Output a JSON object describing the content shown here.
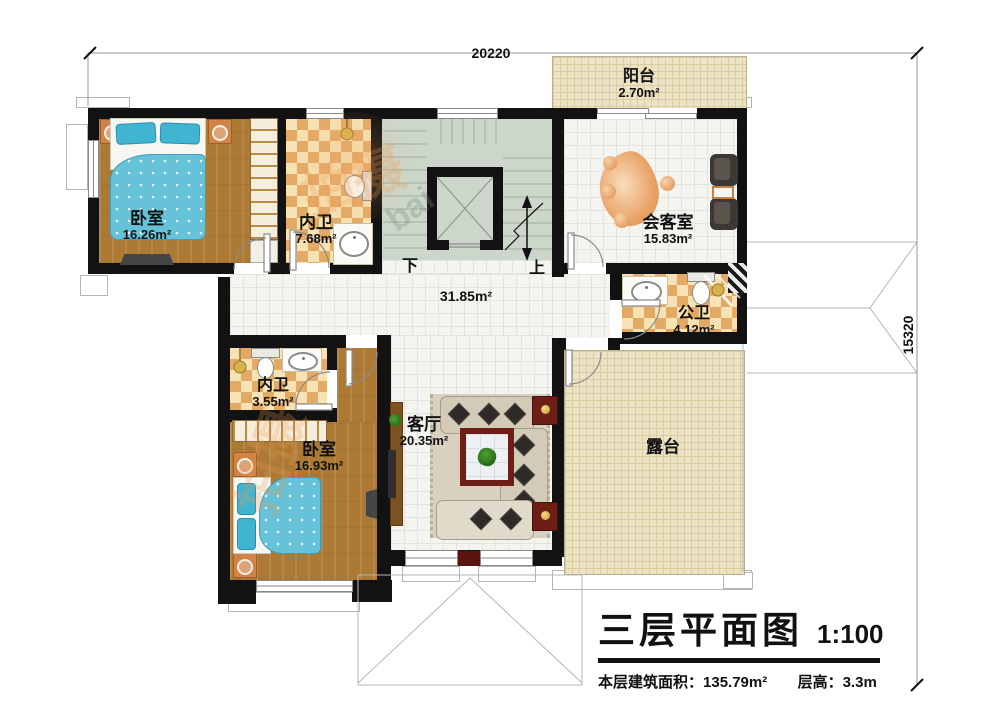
{
  "dimensions": {
    "top": "20220",
    "right": "15320"
  },
  "rooms": {
    "bedroom1": {
      "name": "卧室",
      "area": "16.26m²"
    },
    "bath1": {
      "name": "内卫",
      "area": "7.68m²"
    },
    "reception": {
      "name": "会客室",
      "area": "15.83m²"
    },
    "balcony": {
      "name": "阳台",
      "area": "2.70m²"
    },
    "public_bath": {
      "name": "公卫",
      "area": "4.12m²"
    },
    "bath2": {
      "name": "内卫",
      "area": "3.55m²"
    },
    "bedroom2": {
      "name": "卧室",
      "area": "16.93m²"
    },
    "living": {
      "name": "客厅",
      "area": "20.35m²"
    },
    "terrace": {
      "name": "露台"
    },
    "hall": {
      "area": "31.85m²"
    }
  },
  "stairs": {
    "down": "下",
    "up": "上"
  },
  "title": {
    "name": "三层平面图",
    "scale": "1:100",
    "area_label": "本层建筑面积：",
    "area_value": "135.79m²",
    "height_label": "层高：",
    "height_value": "3.3m"
  },
  "watermark": {
    "cn": "拍摄",
    "latin": "bai"
  }
}
